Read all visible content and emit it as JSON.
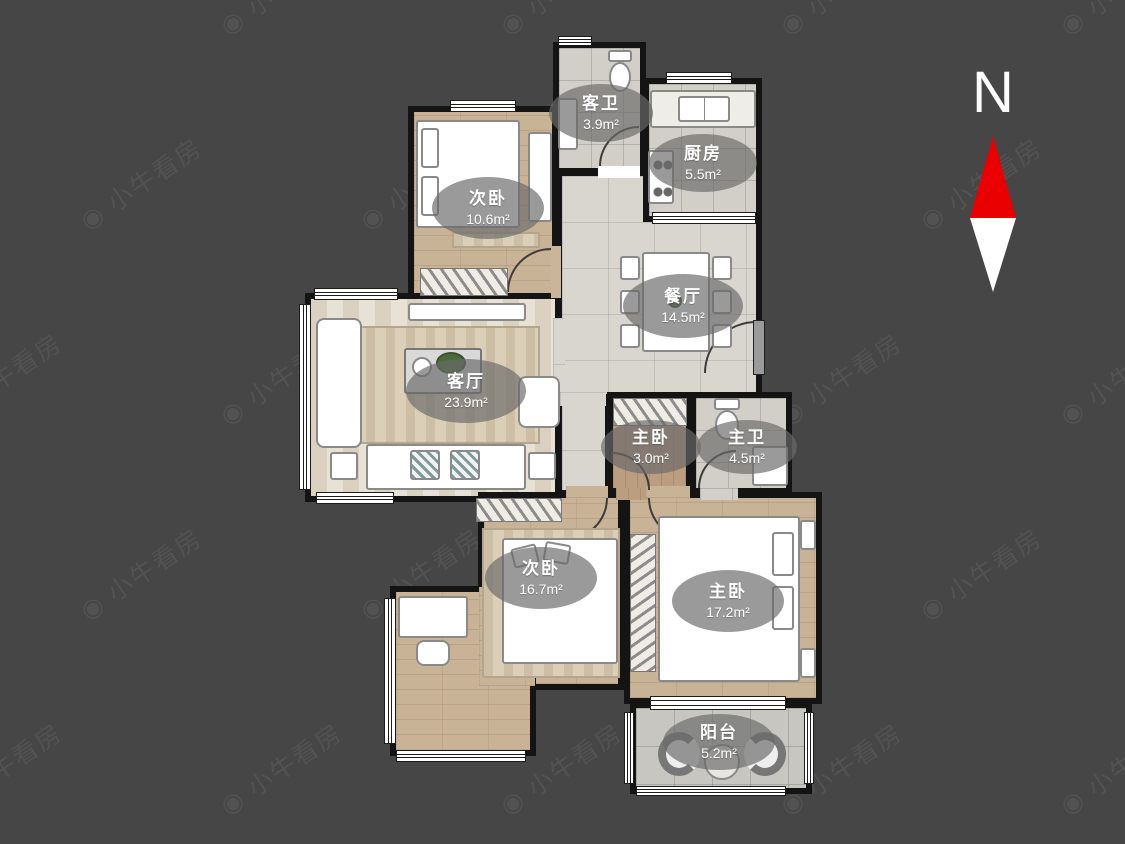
{
  "page": {
    "background": "#464646",
    "wall_color": "#141414"
  },
  "watermark": {
    "text": "小牛看房",
    "icon": "camera-logo-icon"
  },
  "compass": {
    "label": "N",
    "arrow_up_color": "#ea0000",
    "arrow_down_color": "#ffffff"
  },
  "rooms": [
    {
      "id": "bedroom-top",
      "name": "次卧",
      "area": "10.6m²"
    },
    {
      "id": "guest-bathroom",
      "name": "客卫",
      "area": "3.9m²"
    },
    {
      "id": "kitchen",
      "name": "厨房",
      "area": "5.5m²"
    },
    {
      "id": "dining-room",
      "name": "餐厅",
      "area": "14.5m²"
    },
    {
      "id": "living-room",
      "name": "客厅",
      "area": "23.9m²"
    },
    {
      "id": "master-closet",
      "name": "主卧",
      "area": "3.0m²"
    },
    {
      "id": "master-bathroom",
      "name": "主卫",
      "area": "4.5m²"
    },
    {
      "id": "bedroom-2",
      "name": "次卧",
      "area": "16.7m²"
    },
    {
      "id": "master-bedroom",
      "name": "主卧",
      "area": "17.2m²"
    },
    {
      "id": "balcony",
      "name": "阳台",
      "area": "5.2m²"
    }
  ]
}
